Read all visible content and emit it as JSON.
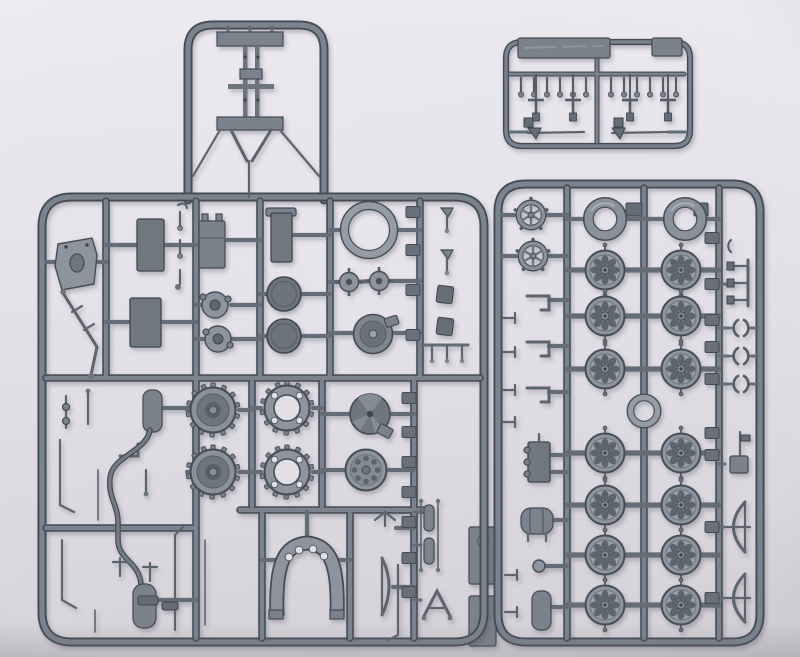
{
  "scene": {
    "description": "Photograph of three grey injection-moulded plastic model-kit sprues (parts frames) with wheels, sprockets, tanks and small fittings, lying on a pale grey surface",
    "background_top": "#edebf0",
    "background_bottom": "#d7d4da",
    "plastic_face": "#8d949e",
    "plastic_mid": "#7b828c",
    "plastic_dark": "#6a717b",
    "plastic_edge": "#474d57"
  },
  "inventory": {
    "road_wheel_count": 14,
    "tire_ring_count": 2,
    "drive_sprocket_count": 2,
    "sprocket_ring_count": 2,
    "idler_wheel_count": 1,
    "small_spoked_wheel_count": 2,
    "sprue_count": 3
  },
  "left_sprue": {
    "drive_sprockets": [
      {
        "x": 213,
        "y": 410
      },
      {
        "x": 213,
        "y": 472
      }
    ],
    "sprocket_rings": [
      {
        "x": 287,
        "y": 408
      },
      {
        "x": 287,
        "y": 472
      }
    ],
    "idler_wheel": {
      "x": 366,
      "y": 470
    },
    "dark_discs": [
      {
        "x": 284,
        "y": 294
      },
      {
        "x": 284,
        "y": 336
      }
    ],
    "axle_hubs": [
      {
        "x": 349,
        "y": 282
      },
      {
        "x": 379,
        "y": 281
      }
    ],
    "large_ring": {
      "x": 369,
      "y": 230
    },
    "runner_tabs": [
      {
        "x": 413,
        "y": 212
      },
      {
        "x": 413,
        "y": 250
      },
      {
        "x": 413,
        "y": 290
      },
      {
        "x": 413,
        "y": 335
      },
      {
        "x": 409,
        "y": 398
      },
      {
        "x": 409,
        "y": 432
      },
      {
        "x": 409,
        "y": 462
      },
      {
        "x": 409,
        "y": 492
      },
      {
        "x": 409,
        "y": 522
      },
      {
        "x": 409,
        "y": 558
      },
      {
        "x": 409,
        "y": 592
      }
    ]
  },
  "right_sprue": {
    "wheel_columns_x": [
      605,
      681
    ],
    "wheel_runner_pairs": [
      [
        567,
        644
      ],
      [
        644,
        719
      ]
    ],
    "upper_wheel_rows_y": [
      270,
      316,
      369
    ],
    "lower_wheel_rows_y": [
      453,
      505,
      555,
      605
    ],
    "tires": [
      {
        "x": 605,
        "y": 219
      },
      {
        "x": 685,
        "y": 219
      }
    ],
    "small_wheels": [
      {
        "x": 531,
        "y": 215
      },
      {
        "x": 533,
        "y": 256
      }
    ],
    "hub_ring": {
      "x": 644,
      "y": 411
    },
    "clip_rows_y": [
      328,
      356,
      384
    ],
    "runner_tabs_y": [
      238,
      284,
      320,
      347,
      379,
      433,
      455,
      527,
      598
    ]
  },
  "small_sprue": {
    "pin_xs_left": [
      521,
      534,
      547,
      560,
      573,
      586
    ],
    "pin_xs_right": [
      611,
      624,
      637,
      650,
      663,
      676
    ],
    "pins_top_y": 77,
    "tool_xs": [
      536,
      573,
      630,
      668
    ],
    "tools_top_y": 100
  }
}
